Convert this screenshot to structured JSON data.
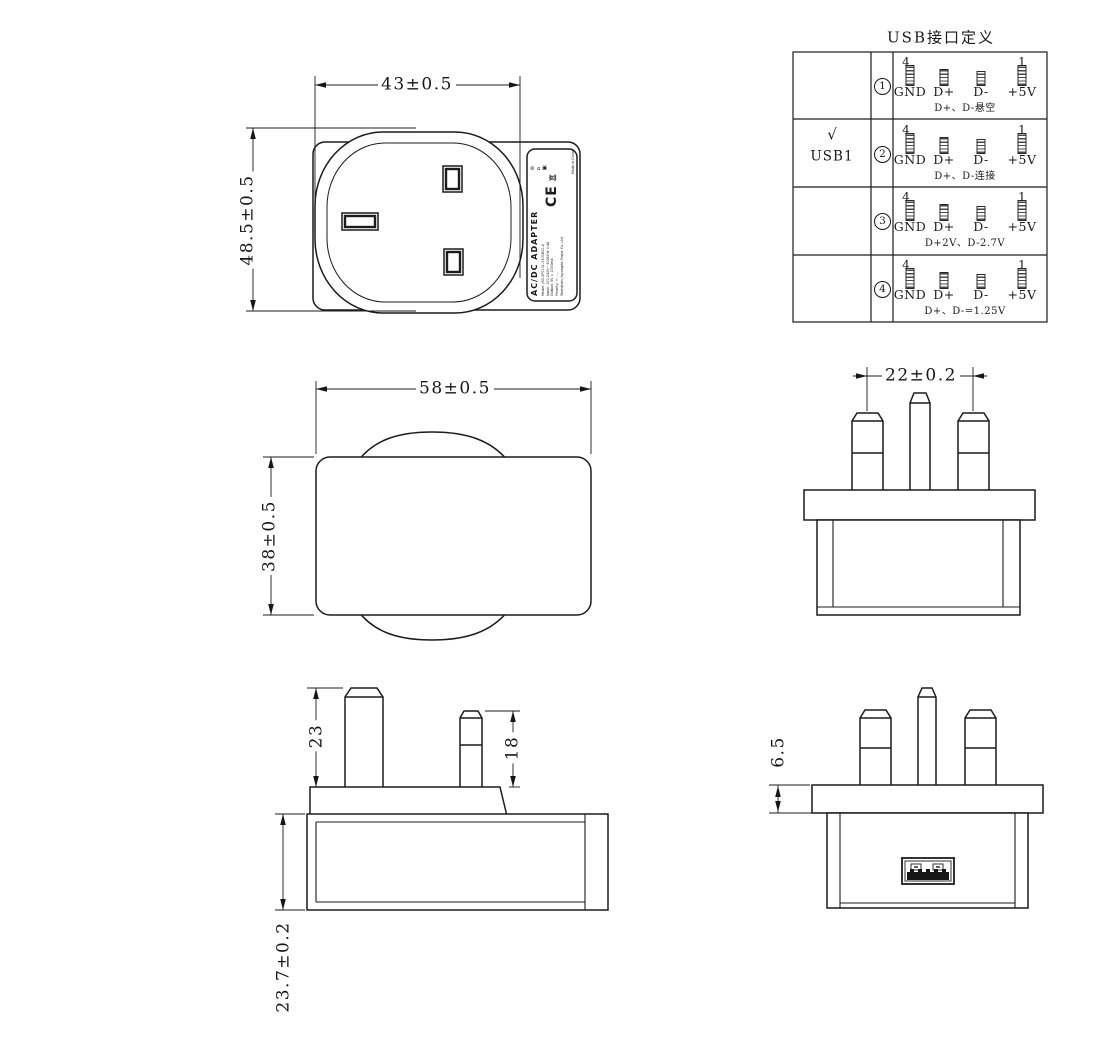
{
  "table": {
    "title": "USB接口定义",
    "rows": [
      {
        "index": "1",
        "selected": "",
        "port": "",
        "first_pin_no": "4",
        "last_pin_no": "1",
        "pins": [
          "GND",
          "D+",
          "D-",
          "+5V"
        ],
        "note": "D+、D-悬空"
      },
      {
        "index": "2",
        "selected": "√",
        "port": "USB1",
        "first_pin_no": "4",
        "last_pin_no": "1",
        "pins": [
          "GND",
          "D+",
          "D-",
          "+5V"
        ],
        "note": "D+、D-连接"
      },
      {
        "index": "3",
        "selected": "",
        "port": "",
        "first_pin_no": "4",
        "last_pin_no": "1",
        "pins": [
          "GND",
          "D+",
          "D-",
          "+5V"
        ],
        "note": "D+2V、D-2.7V"
      },
      {
        "index": "4",
        "selected": "",
        "port": "",
        "first_pin_no": "4",
        "last_pin_no": "1",
        "pins": [
          "GND",
          "D+",
          "D-",
          "+5V"
        ],
        "note": "D+、D-=1.25V"
      }
    ]
  },
  "dimensions": {
    "front_width": "43±0.5",
    "front_height": "48.5±0.5",
    "top_width": "58±0.5",
    "top_depth": "38±0.5",
    "pin_spacing": "22±0.2",
    "earth_pin_length": "23",
    "line_pin_length": "18",
    "body_height": "23.7±0.2",
    "flange_thickness": "6.5"
  },
  "label": {
    "product": "AC/DC ADAPTER",
    "lines": [
      "Model: JB0-5P0101-0500B00-A",
      "Input: 100-240V~ 50/60Hz 0.4A",
      "Output: 5V = 2000mA",
      "Polarity: + - - -",
      "Shenzhen Jinyongda Power Co.,Ltd"
    ],
    "ce_mark": "CE",
    "cert_icons": "⊚ ⌂ ▣",
    "made_in": "Made in China"
  }
}
